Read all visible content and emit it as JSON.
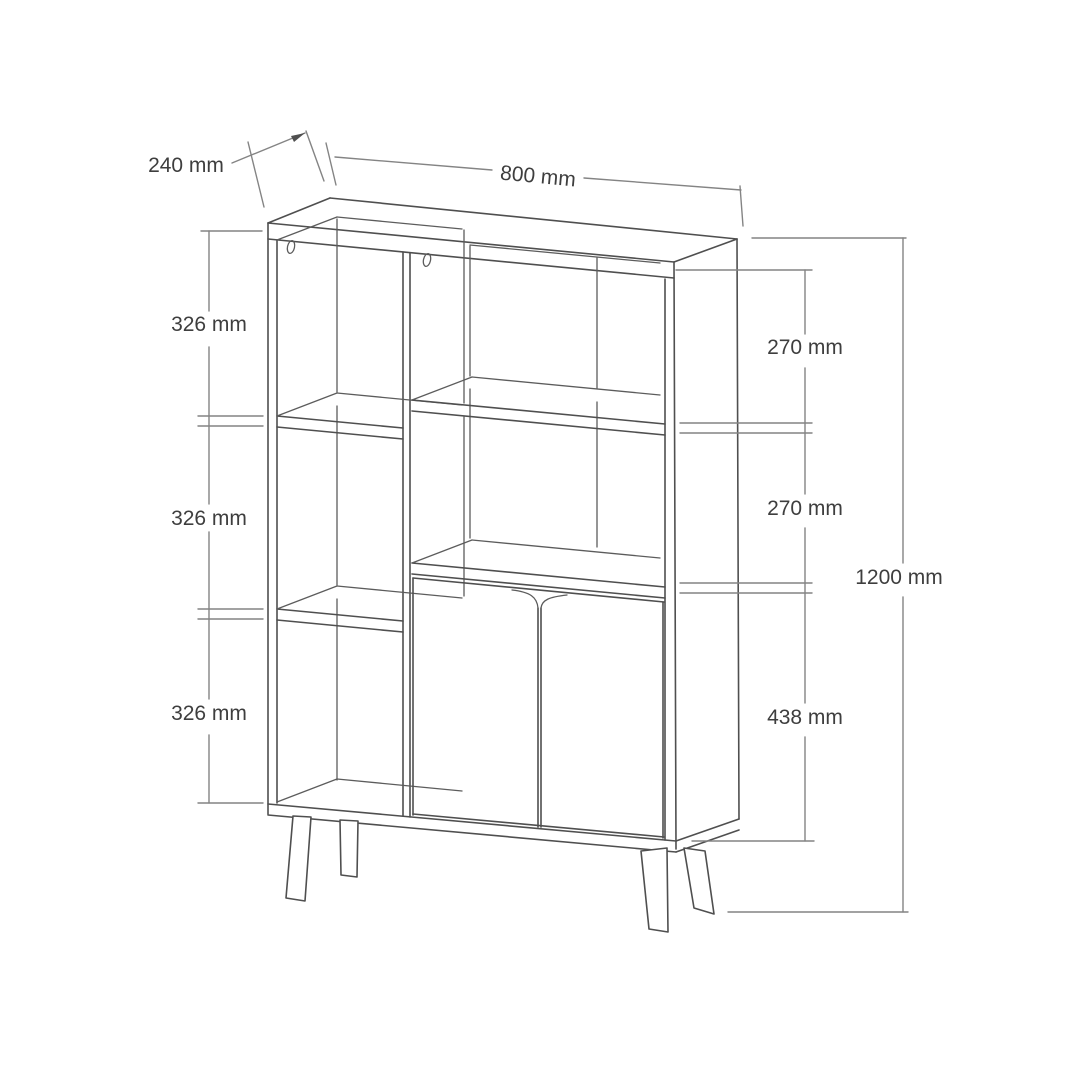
{
  "drawing": {
    "dimensions": {
      "depth_label": "240 mm",
      "width_label": "800 mm",
      "left_sections": [
        "326 mm",
        "326 mm",
        "326 mm"
      ],
      "right_sections": [
        "270 mm",
        "270 mm",
        "438 mm"
      ],
      "height_label": "1200 mm"
    },
    "colors": {
      "background": "#ffffff",
      "cabinet_line": "#4f4f4f",
      "dimension_line": "#848484",
      "text": "#3e3e3e"
    }
  }
}
